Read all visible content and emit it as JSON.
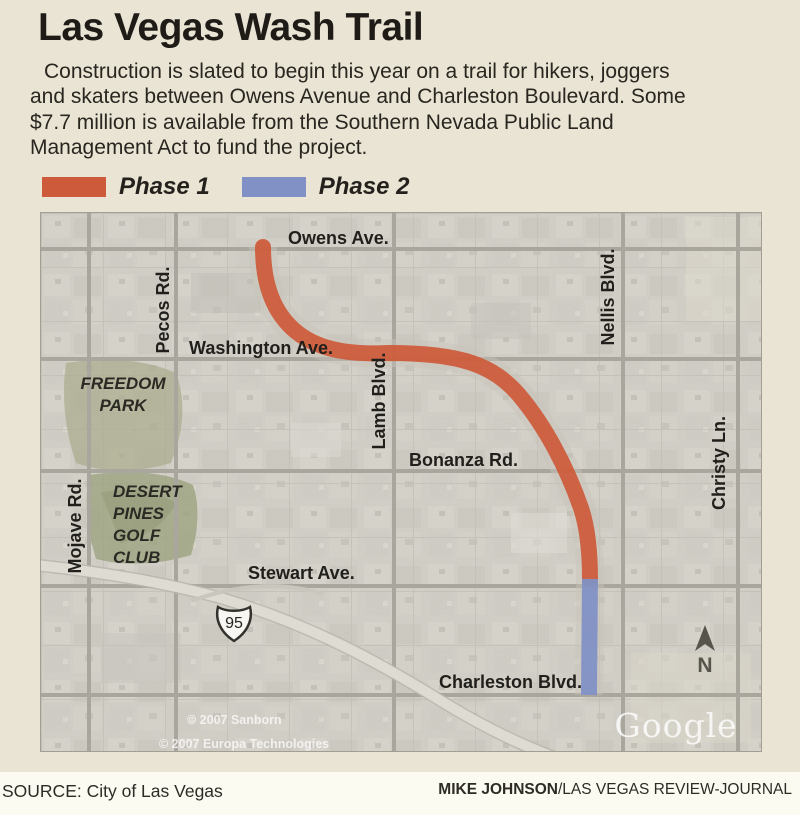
{
  "title": "Las Vegas Wash Trail",
  "description_lines": [
    "Construction is slated to begin this year on a trail for hikers, joggers",
    "and skaters between Owens Avenue and Charleston Boulevard. Some",
    "$7.7 million is available from the Southern Nevada Public Land",
    "Management Act to fund the project."
  ],
  "legend": {
    "phase1": "Phase 1",
    "phase2": "Phase 2"
  },
  "colors": {
    "phase1": "#cd5a3a",
    "phase2": "#8191c5",
    "panel_bg": "#e9e4d4"
  },
  "map": {
    "labels": {
      "owens": "Owens Ave.",
      "pecos": "Pecos Rd.",
      "washington": "Washington Ave.",
      "nellis": "Nellis Blvd.",
      "freedom_1": "FREEDOM",
      "freedom_2": "PARK",
      "lamb": "Lamb Blvd.",
      "bonanza": "Bonanza Rd.",
      "christy": "Christy Ln.",
      "mojave": "Mojave Rd.",
      "desert_1": "DESERT",
      "desert_2": "PINES",
      "desert_3": "GOLF",
      "desert_4": "CLUB",
      "stewart": "Stewart Ave.",
      "charleston": "Charleston Blvd.",
      "highway_shield": "95",
      "north": "N",
      "watermark": "Google",
      "copyright_1": "© 2007 Sanborn",
      "copyright_2": "© 2007 Europa Technologies"
    }
  },
  "footer": {
    "source": "SOURCE: City of Las Vegas",
    "credit_name": "MIKE JOHNSON",
    "credit_org": "/LAS VEGAS REVIEW-JOURNAL"
  }
}
